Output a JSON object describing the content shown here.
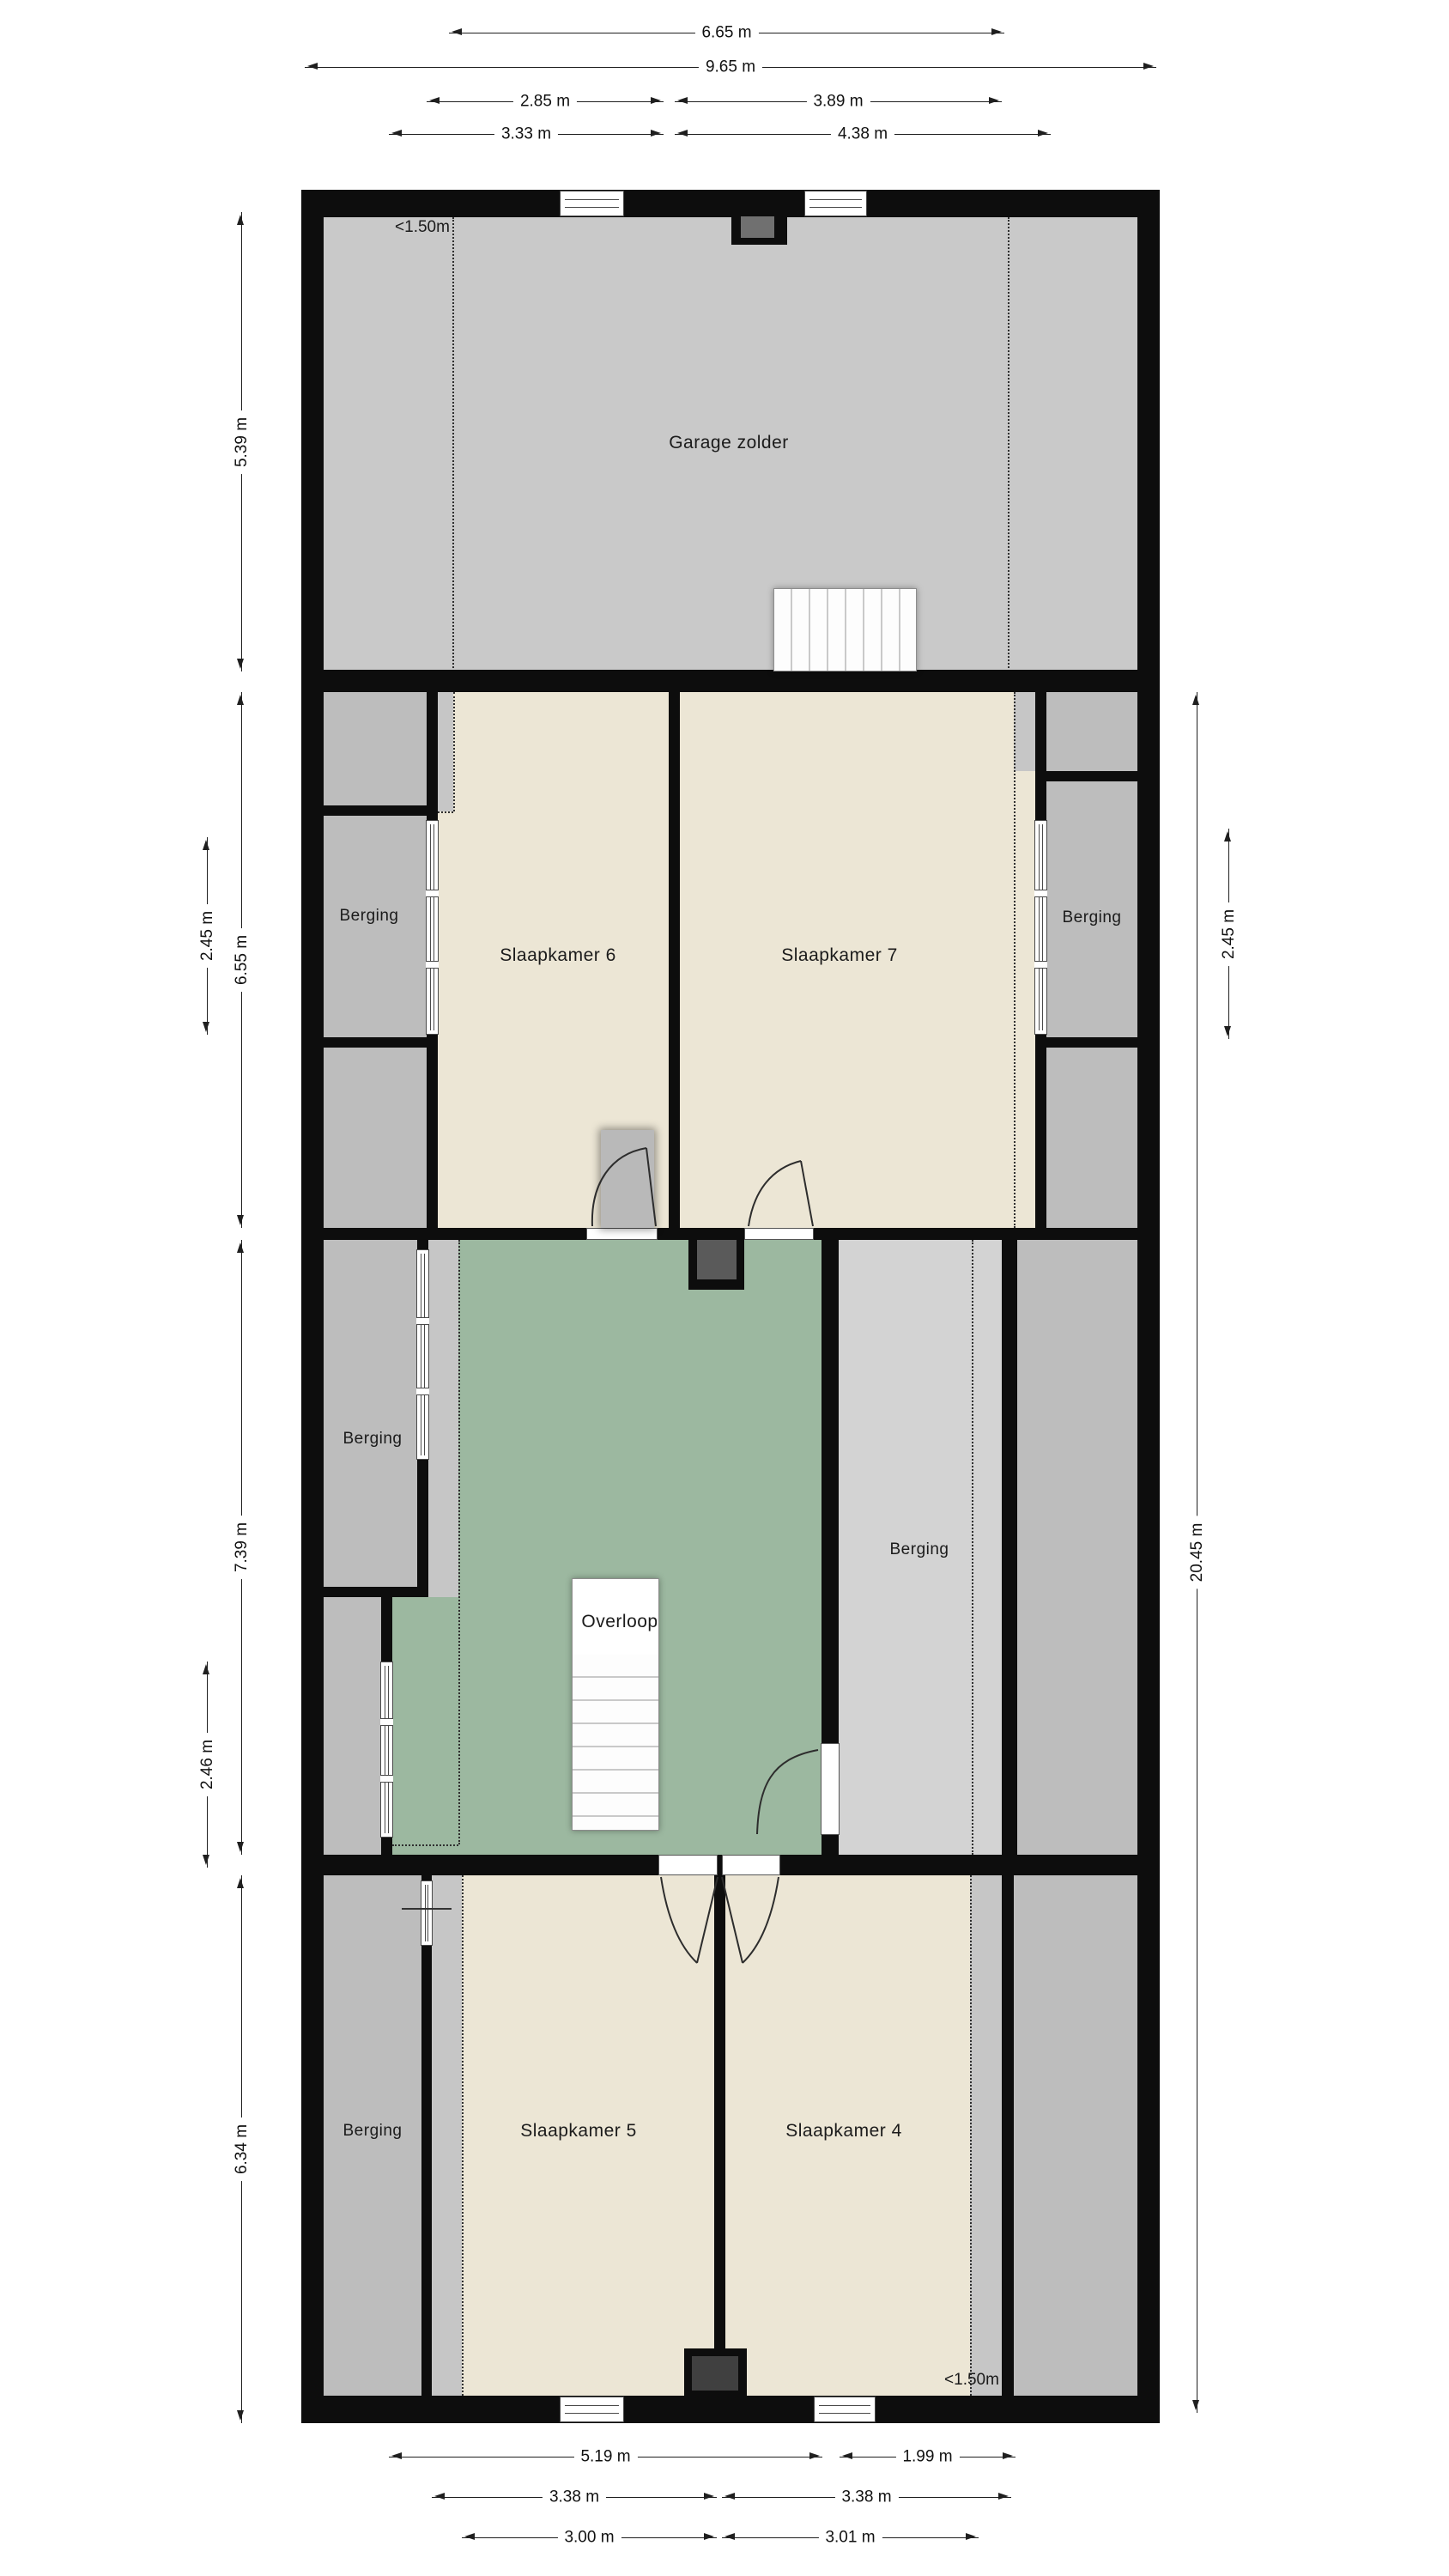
{
  "plan": {
    "rooms": {
      "garage": "Garage zolder",
      "slaapkamer6": "Slaapkamer 6",
      "slaapkamer7": "Slaapkamer 7",
      "overloop": "Overloop",
      "slaapkamer5": "Slaapkamer 5",
      "slaapkamer4": "Slaapkamer 4",
      "berging_mid_left": "Berging",
      "berging_mid_right": "Berging",
      "berging_overloop_left": "Berging",
      "berging_overloop_right": "Berging",
      "berging_bottom_left": "Berging"
    },
    "annotations": {
      "height_limit_top": "<1.50m",
      "height_limit_bottom": "<1.50m"
    },
    "colors": {
      "wall": "#0d0d0d",
      "garage_floor": "#c9c9c9",
      "storage_floor": "#bdbdbd",
      "storage_light_floor": "#d3d3d3",
      "strip_floor": "#c6c6c6",
      "bedroom_floor": "#ece6d5",
      "landing_floor": "#9cb8a0",
      "page_bg": "#ffffff"
    }
  },
  "dimensions": {
    "top": [
      {
        "label": "6.65 m"
      },
      {
        "label": "9.65 m"
      },
      {
        "label": "2.85 m"
      },
      {
        "label": "3.89 m"
      },
      {
        "label": "3.33 m"
      },
      {
        "label": "4.38 m"
      }
    ],
    "left": [
      {
        "label": "5.39 m"
      },
      {
        "label": "2.45 m"
      },
      {
        "label": "6.55 m"
      },
      {
        "label": "7.39 m"
      },
      {
        "label": "2.46 m"
      },
      {
        "label": "6.34 m"
      }
    ],
    "right": [
      {
        "label": "2.45 m"
      },
      {
        "label": "20.45 m"
      }
    ],
    "bottom": [
      {
        "label": "5.19 m"
      },
      {
        "label": "1.99 m"
      },
      {
        "label": "3.38 m"
      },
      {
        "label": "3.38 m"
      },
      {
        "label": "3.00 m"
      },
      {
        "label": "3.01 m"
      }
    ]
  }
}
